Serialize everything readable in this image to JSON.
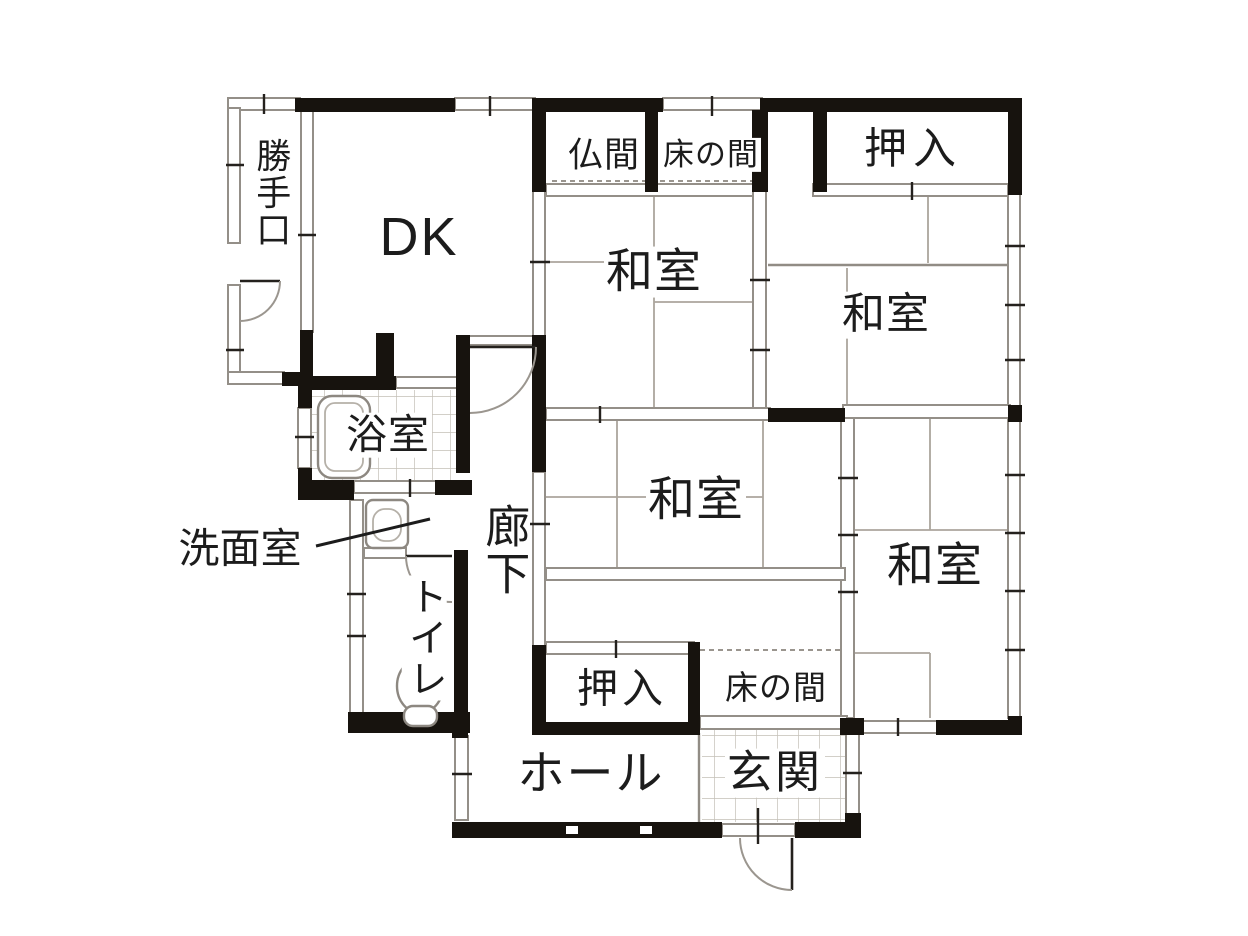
{
  "rooms": {
    "katteguchi": "勝手口",
    "dk": "DK",
    "butsuma": "仏間",
    "tokonoma_top": "床の間",
    "oshiire_top": "押入",
    "washitsu_top_center": "和室",
    "washitsu_top_right": "和室",
    "washitsu_center": "和室",
    "washitsu_bottom_right": "和室",
    "yokushitsu": "浴室",
    "senmenshitsu": "洗面室",
    "rouka": "廊下",
    "toire": "トイレ",
    "oshiire_bottom": "押入",
    "tokonoma_bottom": "床の間",
    "hall": "ホール",
    "genkan": "玄関"
  },
  "icons": [
    "bathtub-icon",
    "washbasin-icon",
    "toilet-icon"
  ],
  "doors": [
    "katteguchi-door",
    "dk-corridor-door",
    "toilet-door",
    "entrance-door"
  ],
  "colors": {
    "wall": "#17130e",
    "partition": "#948f88",
    "tile_line": "#c3bfb6",
    "text": "#1c1c1c",
    "background": "#ffffff"
  }
}
